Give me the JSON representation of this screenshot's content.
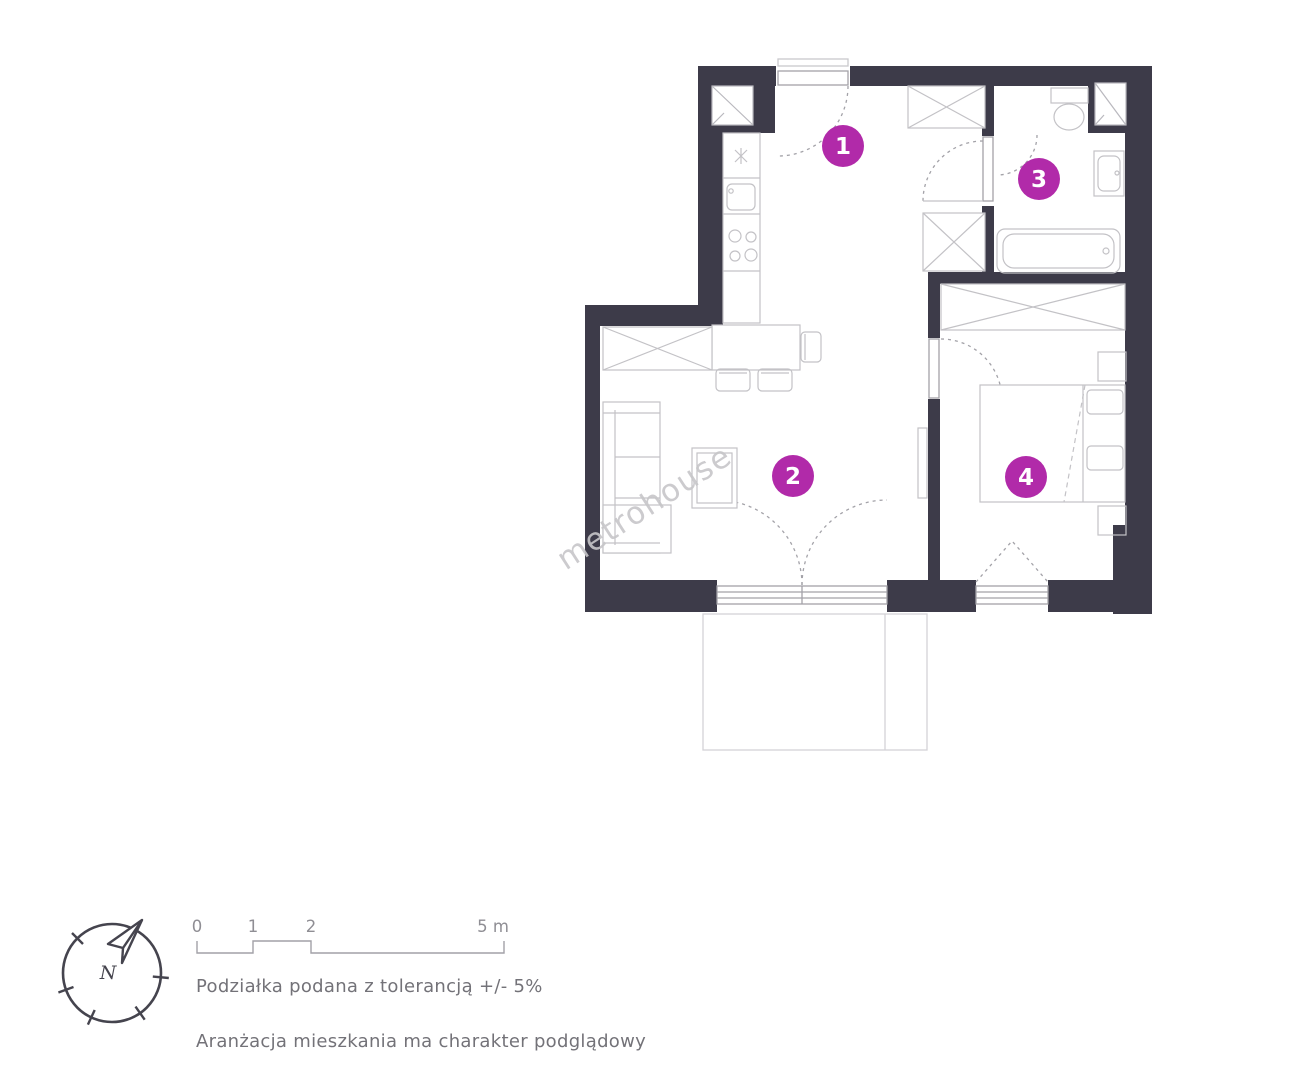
{
  "watermark": "metrohouse",
  "plan": {
    "room_markers": [
      "1",
      "2",
      "3",
      "4"
    ],
    "colors": {
      "wall": "#3d3b49",
      "marker": "#b12aa9",
      "furniture": "#c3c2c6",
      "frame": "#a3a2a8"
    }
  },
  "legend": {
    "compass_label": "N",
    "scale_ticks": [
      "0",
      "1",
      "2"
    ],
    "scale_end_label": "5 m",
    "tolerance_note": "Podziałka podana z tolerancją +/- 5%",
    "disclaimer": "Aranżacja mieszkania ma charakter podglądowy"
  }
}
